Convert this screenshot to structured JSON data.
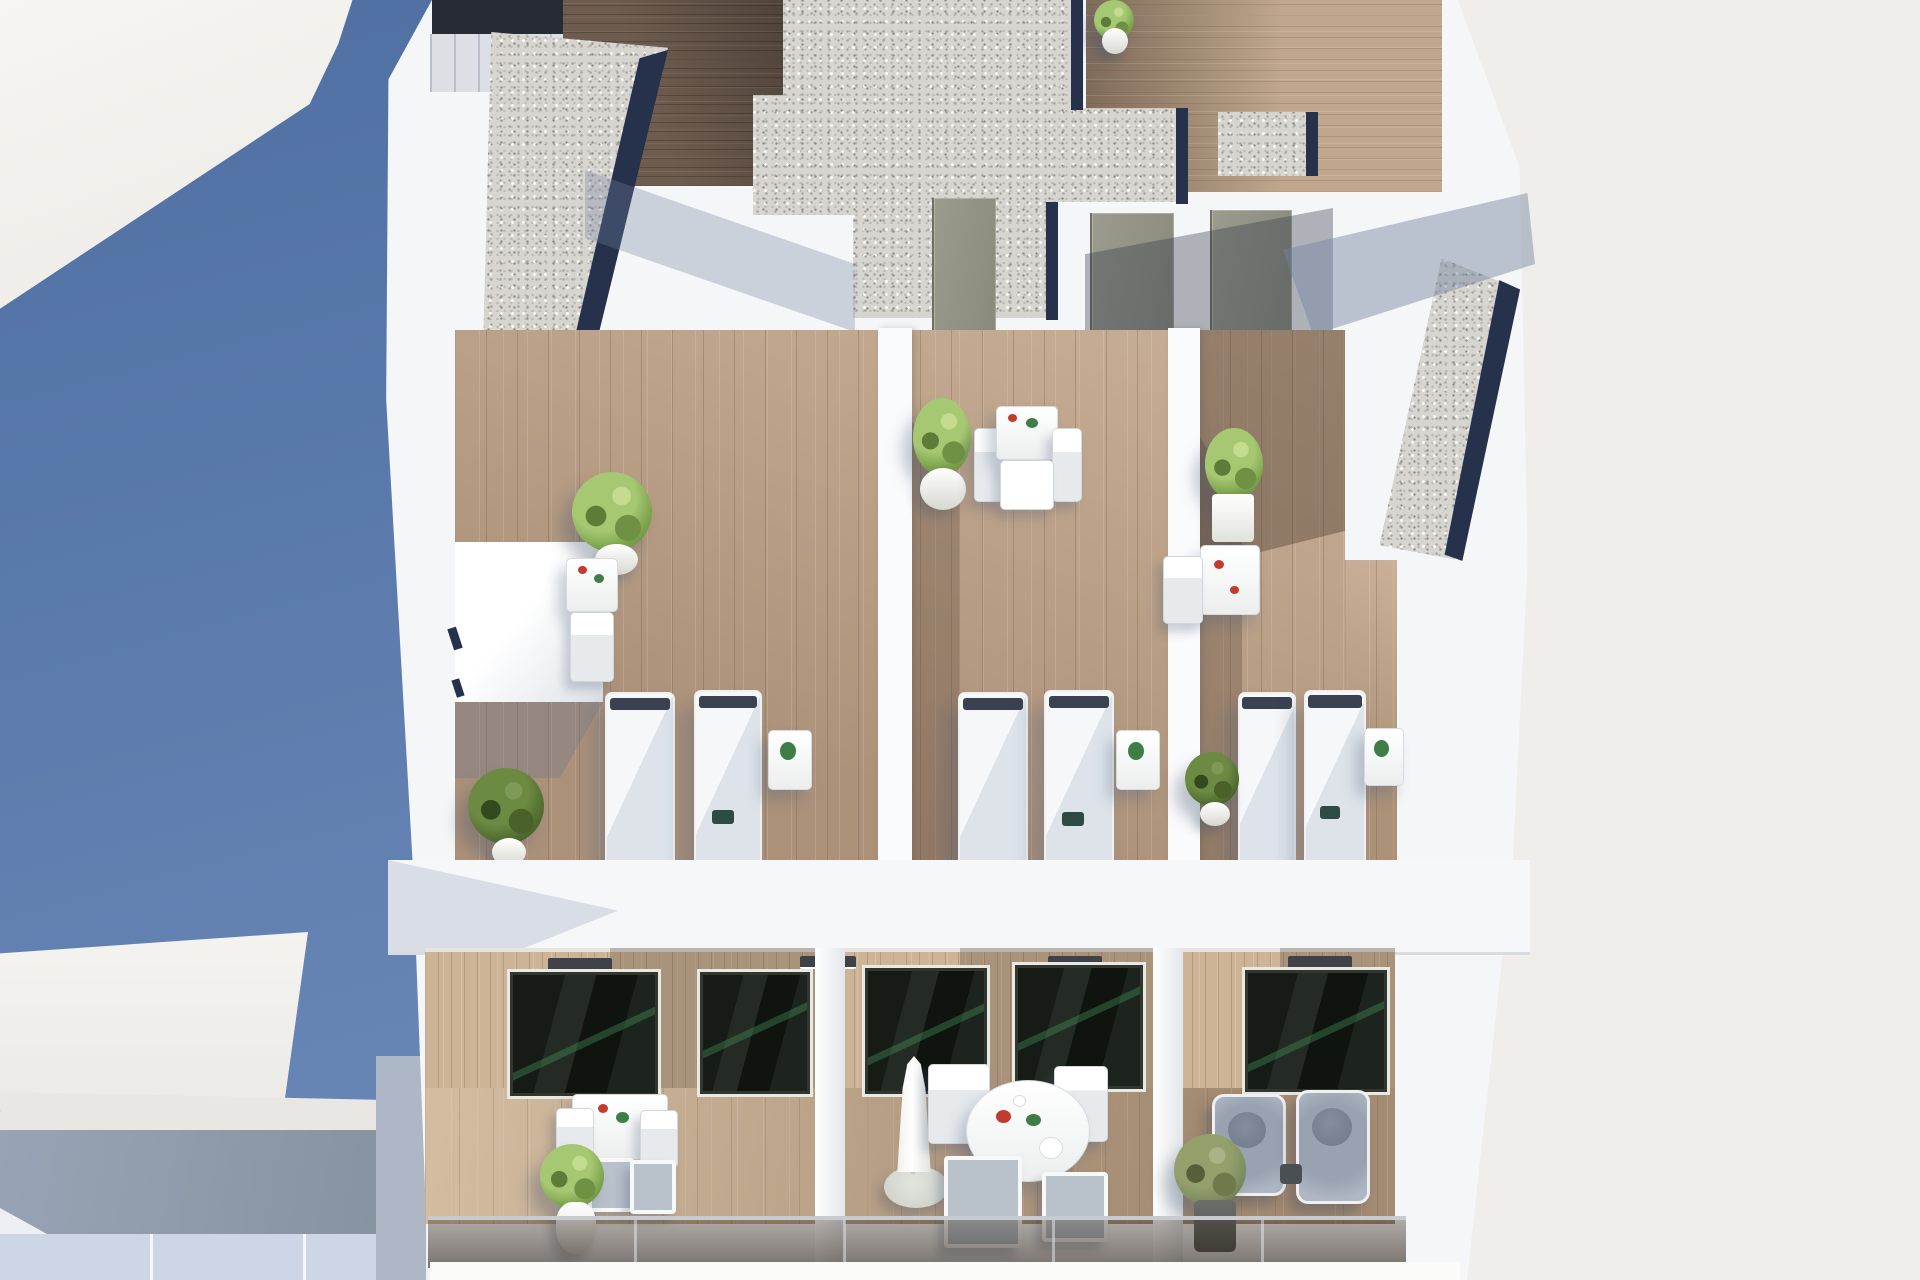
{
  "scene": {
    "description": "Aerial 3D architectural rendering of a white apartment building rooftop: three roof terraces with wooden decking, white sun loungers, potted plants and bistro sets; gravel roof strips with navy drainage edges; a lower floor with three furnished balconies behind a tinted glass balustrade; deep blue water/shadow area at the lower left and a plain off-white ground plane at the right.",
    "label": "aerial-building-render"
  },
  "palette": {
    "sky_blue_top": "#4f6ea2",
    "sky_blue_bottom": "#6886b5",
    "offwhite_bg": "#f0eeea",
    "building_white": "#f5f6f8",
    "gravel": "#d7d5d0",
    "gravel_edge_navy": "#26324c",
    "terrace_wood": "#b99f87",
    "dark_deck_wood": "#6e5c4f",
    "light_deck_wood": "#bfa68c",
    "balcony_wall_wood": "#cdb497",
    "glass_dark": "#161b16",
    "door_grey": "#94948a",
    "shadow_blue": "#8ea0bf",
    "lounger_white": "#f5f7f9",
    "plant_green": "#7ca24c",
    "plant_olive": "#7d8a5f",
    "armchair_grey": "#98a2b0",
    "umbrella_white": "#f2f2ee",
    "balustrade_tint": "rgba(44,34,24,0.62)"
  },
  "inventory": {
    "rooftop": {
      "terrace_count": 3,
      "sun_loungers": 6,
      "lounger_side_tables_with_plant": 3,
      "bistro_sets": 3,
      "potted_plants": 6,
      "gravel_roof_areas": 4,
      "grey_service_doors": 3,
      "stair_bulkheads": 1
    },
    "lower_floor": {
      "balcony_count": 3,
      "sliding_glass_doors": 5,
      "balcony_left": {
        "square_table": 1,
        "chairs": 2,
        "stools": 2,
        "potted_plant": 1
      },
      "balcony_middle": {
        "round_table": 1,
        "chairs": 4,
        "closed_parasol": 1
      },
      "balcony_right": {
        "lounge_armchairs": 2,
        "potted_plant": 1,
        "side_table": 1
      },
      "glass_balustrade": true
    },
    "surroundings": {
      "blue_water_or_shadow_area": true,
      "neighboring_white_rooftop_lower_left": true,
      "plain_ground_right": true
    }
  }
}
